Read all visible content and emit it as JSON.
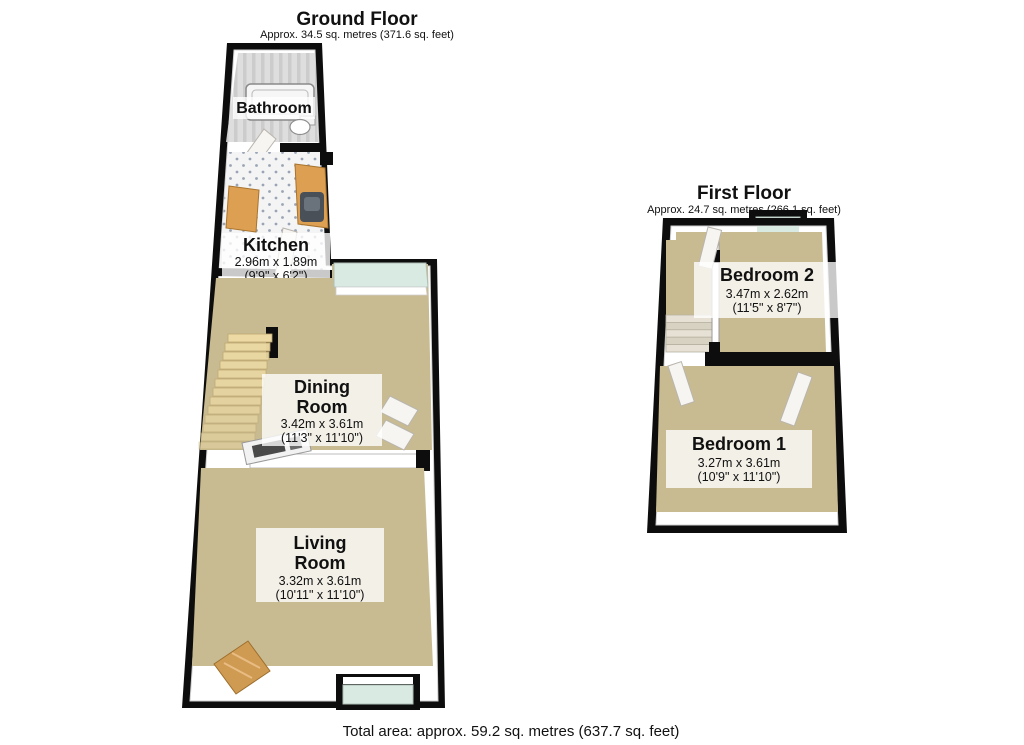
{
  "ground_floor": {
    "title": "Ground Floor",
    "subtitle": "Approx. 34.5 sq. metres (371.6 sq. feet)",
    "rooms": {
      "bathroom": {
        "name": "Bathroom"
      },
      "kitchen": {
        "name": "Kitchen",
        "metric": "2.96m x 1.89m",
        "imperial": "(9'9\" x 6'2\")"
      },
      "dining": {
        "name_line1": "Dining",
        "name_line2": "Room",
        "metric": "3.42m x 3.61m",
        "imperial": "(11'3\" x 11'10\")"
      },
      "living": {
        "name_line1": "Living",
        "name_line2": "Room",
        "metric": "3.32m x 3.61m",
        "imperial": "(10'11\" x 11'10\")"
      }
    }
  },
  "first_floor": {
    "title": "First Floor",
    "subtitle": "Approx. 24.7 sq. metres (266.1 sq. feet)",
    "rooms": {
      "bedroom2": {
        "name": "Bedroom 2",
        "metric": "3.47m x 2.62m",
        "imperial": "(11'5\" x 8'7\")"
      },
      "bedroom1": {
        "name": "Bedroom 1",
        "metric": "3.27m x 3.61m",
        "imperial": "(10'9\" x 11'10\")"
      }
    }
  },
  "footer": {
    "total_area": "Total area: approx. 59.2 sq. metres (637.7 sq. feet)"
  },
  "colors": {
    "wall": "#0d0d0d",
    "carpet": "#c8bb92",
    "glass": "#d9eae2",
    "wood": "#dd9f52",
    "stair_wood": "#ecd9a4",
    "bathroom_floor": "#dcdcdc",
    "kitchen_tile": "#f4f4f4",
    "sink": "#4a5058"
  }
}
